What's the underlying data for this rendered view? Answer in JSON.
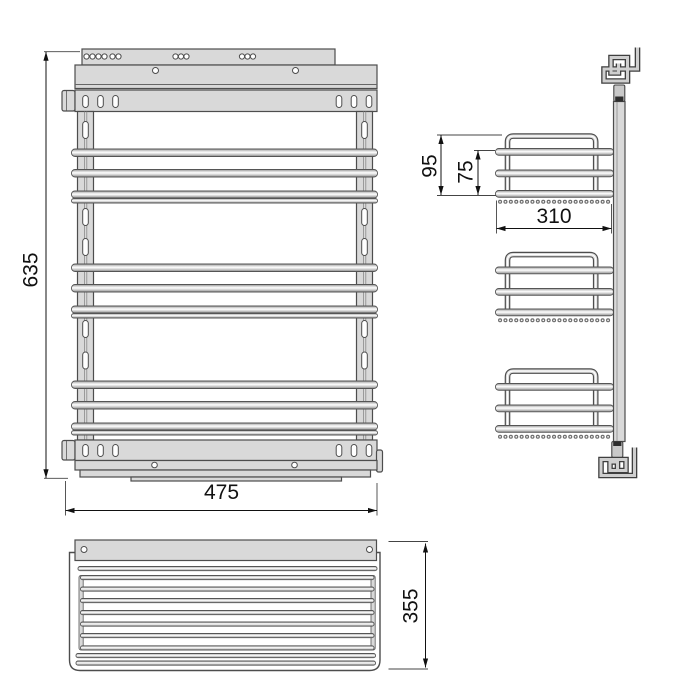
{
  "drawing": {
    "dimensions": {
      "overall_height_mm": "635",
      "overall_width_mm": "475",
      "overall_depth_mm": "355",
      "basket_depth_mm": "310",
      "basket_total_height_mm": "95",
      "basket_side_height_mm": "75"
    }
  }
}
